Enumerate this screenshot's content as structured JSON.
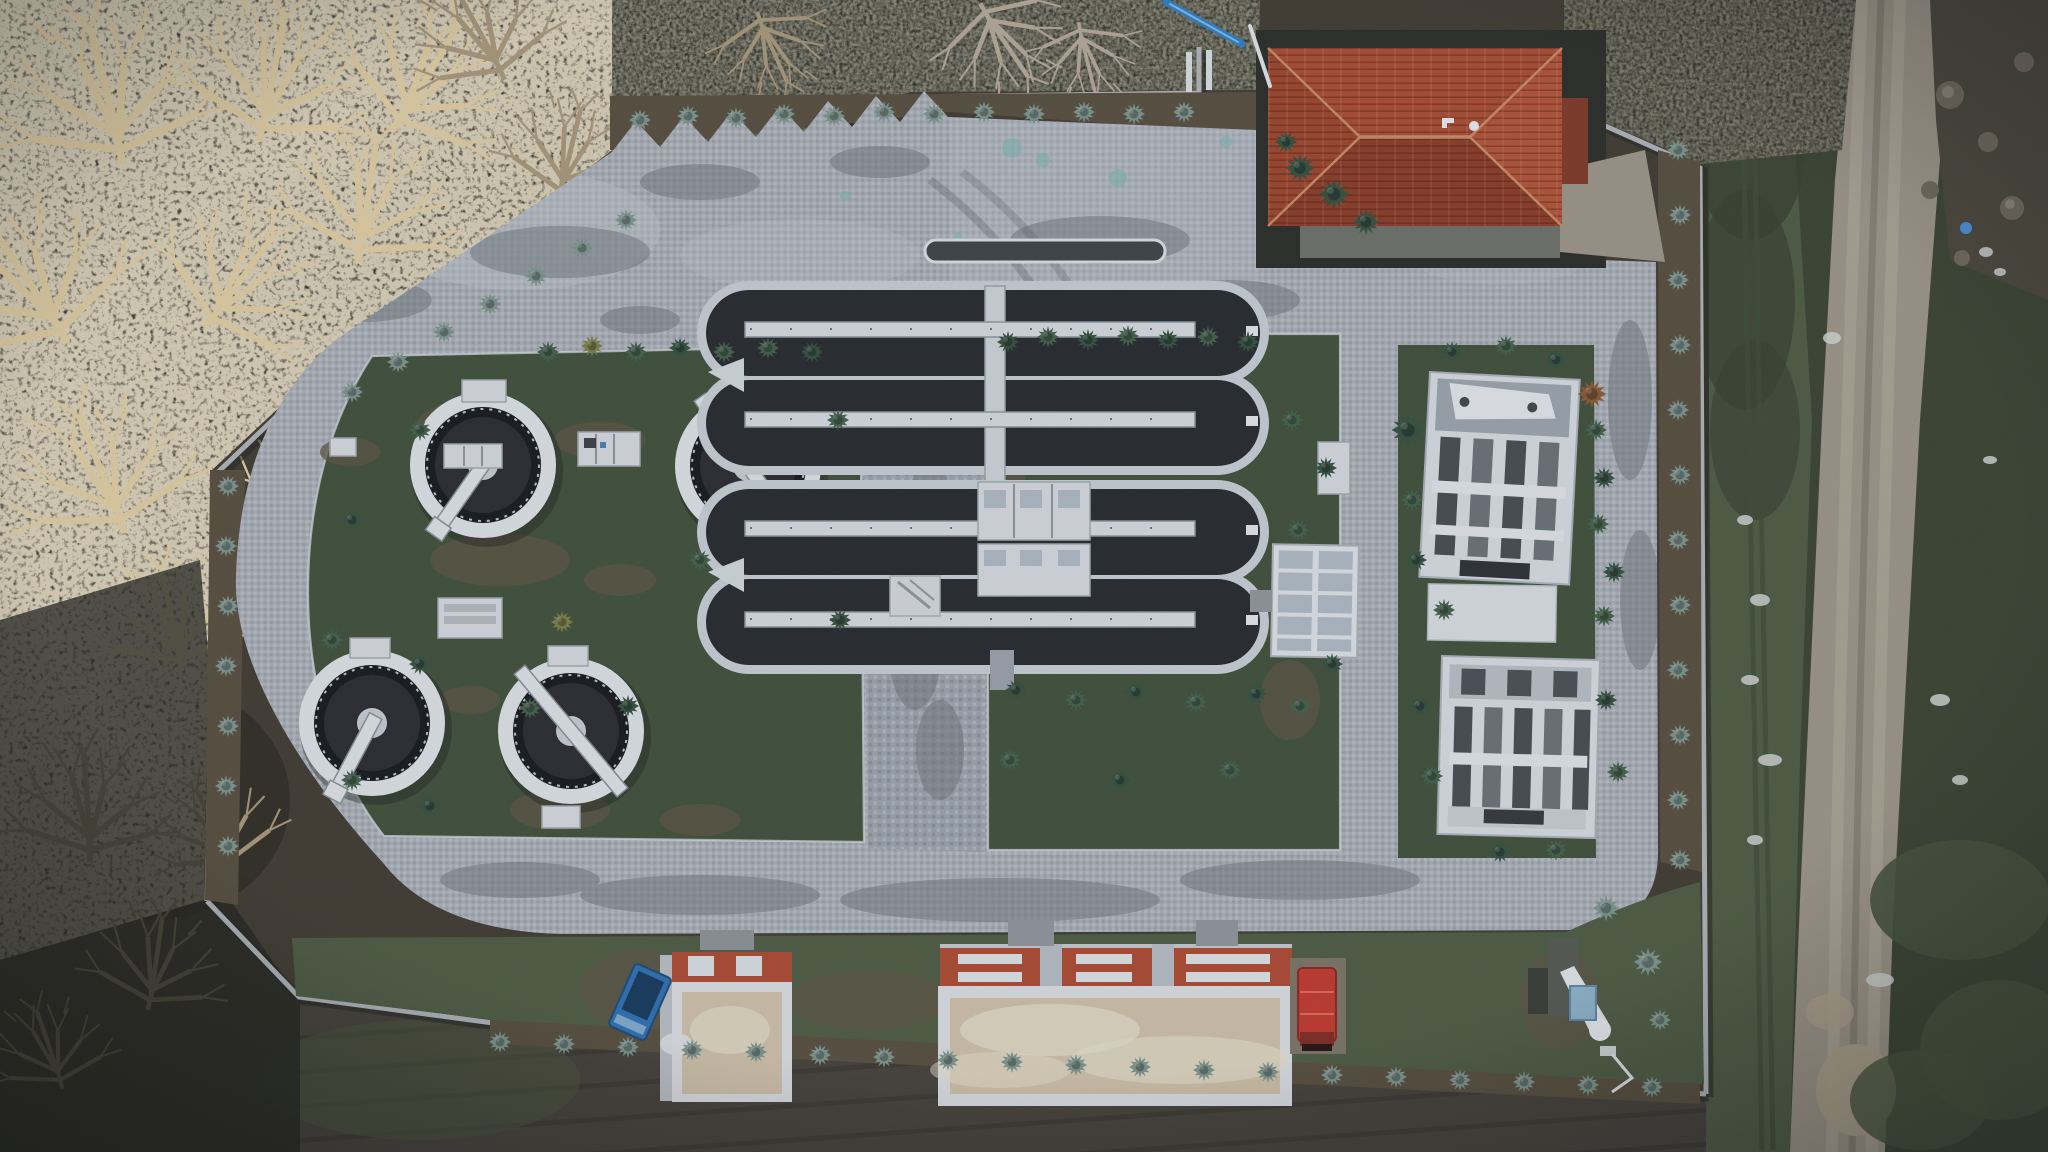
{
  "scene": {
    "type": "aerial-drone-photo-top-down",
    "subject": "Aerial top-down view of a wastewater treatment plant at dusk in winter",
    "setting": "Walled compound with cobblestone paving and lawns, bordered by bare golden trees on the left, a dirt track on the right and a plowed field below"
  },
  "counts": {
    "circular_clarifiers": 4,
    "oxidation_channel_groups": 2,
    "channels_per_group": 2,
    "aerator_bridges": 4,
    "filter_units": 2,
    "red_hip_roof_buildings": 1,
    "flat_roof_buildings": 2,
    "red_trucks": 1,
    "blue_trailers": 1
  },
  "colors": {
    "pavement": "#a9aeb5",
    "pavement_light": "#c3c8ce",
    "pavement_dark": "#7e848b",
    "grass": "#4e5b41",
    "grass_dark": "#41503a",
    "mulch": "#584e3d",
    "water_dark": "#27292d",
    "tank_ring": "#17191c",
    "concrete": "#c7cdd3",
    "concrete_bright": "#dde1e5",
    "wall": "#b4b9bd",
    "roof_red": "#a84c31",
    "roof_red_dark": "#8c3c26",
    "roof_beige": "#cec0a7",
    "truck_red": "#c13a2d",
    "trailer_blue": "#2f6fae",
    "pipe_blue": "#2e7fc4",
    "dirt_road": "#9c9486",
    "forest_floor": "#3f3930",
    "scrub": "#343629",
    "field_soil": "#45413a",
    "conifer_blue": "#7d948b",
    "conifer_green": "#44604a",
    "conifer_dark": "#35503f",
    "conifer_yellow": "#7d7f46",
    "conifer_orange": "#8a5a33",
    "branch_gold": "#e0cda0",
    "branch_gold_dim": "#a8977a",
    "branch_gray": "#b3a896",
    "stone": "#6e685a",
    "snow_patch": "#cfd3cf",
    "teal_stain": "#79b7ae"
  }
}
